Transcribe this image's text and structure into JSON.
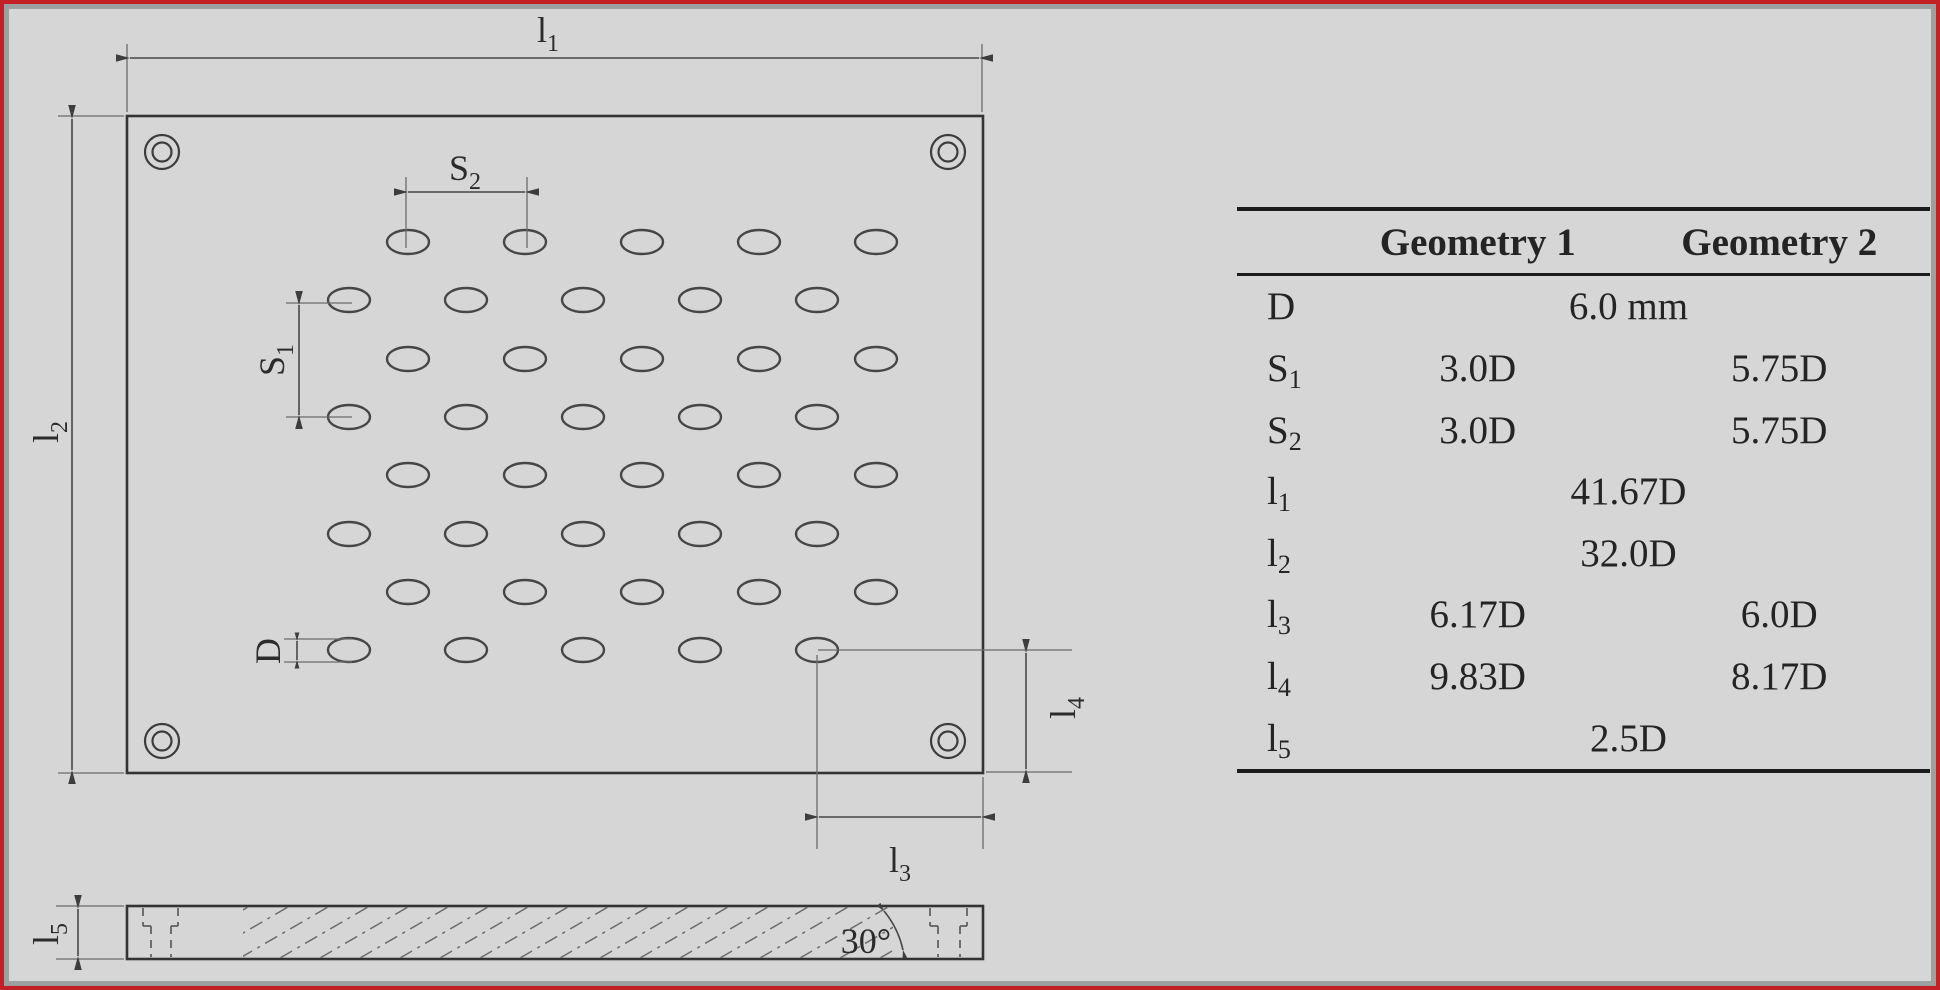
{
  "frame": {
    "outer_border_color": "#c32125",
    "inner_border_color": "#9da0a0",
    "background": "#d6d6d6"
  },
  "drawing": {
    "line_color": "#3d3d3d",
    "holes": {
      "rows": 8,
      "cols": 5
    },
    "labels": {
      "l1": {
        "base": "l",
        "sub": "1"
      },
      "l2": {
        "base": "l",
        "sub": "2"
      },
      "l3": {
        "base": "l",
        "sub": "3"
      },
      "l4": {
        "base": "l",
        "sub": "4"
      },
      "l5": {
        "base": "l",
        "sub": "5"
      },
      "s1": {
        "base": "S",
        "sub": "1"
      },
      "s2": {
        "base": "S",
        "sub": "2"
      },
      "d": {
        "base": "D",
        "sub": ""
      },
      "angle": "30°"
    }
  },
  "table": {
    "headers": [
      "",
      "Geometry 1",
      "Geometry 2"
    ],
    "rows": [
      {
        "param_base": "D",
        "param_sub": "",
        "span": "6.0 mm"
      },
      {
        "param_base": "S",
        "param_sub": "1",
        "g1": "3.0D",
        "g2": "5.75D"
      },
      {
        "param_base": "S",
        "param_sub": "2",
        "g1": "3.0D",
        "g2": "5.75D"
      },
      {
        "param_base": "l",
        "param_sub": "1",
        "span": "41.67D"
      },
      {
        "param_base": "l",
        "param_sub": "2",
        "span": "32.0D"
      },
      {
        "param_base": "l",
        "param_sub": "3",
        "g1": "6.17D",
        "g2": "6.0D"
      },
      {
        "param_base": "l",
        "param_sub": "4",
        "g1": "9.83D",
        "g2": "8.17D"
      },
      {
        "param_base": "l",
        "param_sub": "5",
        "span": "2.5D"
      }
    ]
  }
}
